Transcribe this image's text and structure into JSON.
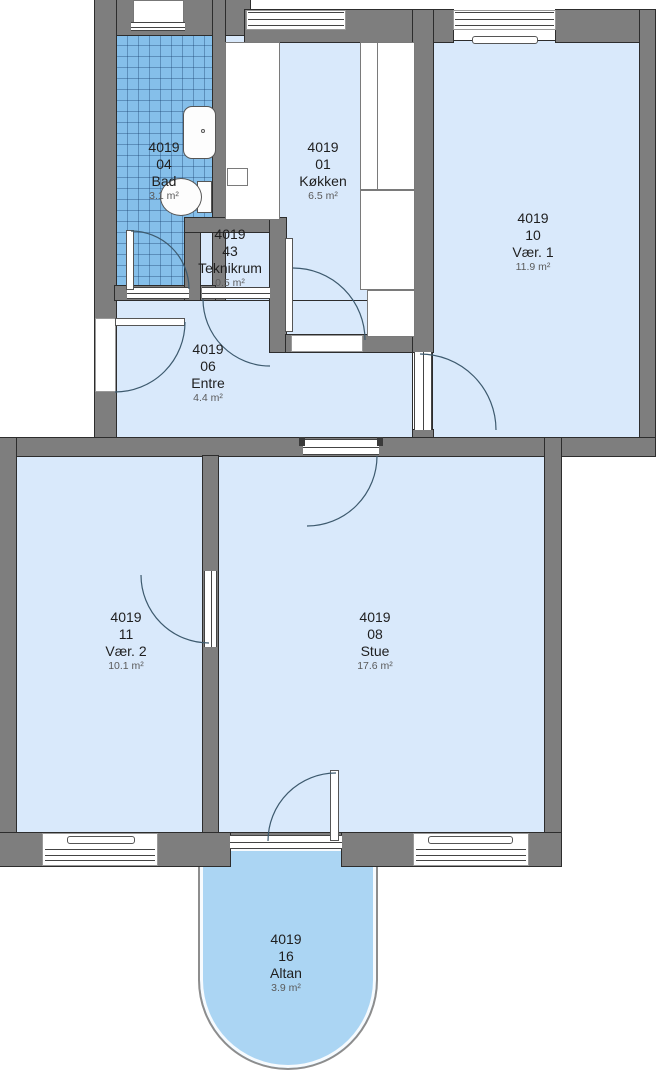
{
  "plan": {
    "unit": "4019",
    "rooms": [
      {
        "unit": "4019",
        "number": "04",
        "name": "Bad",
        "area": "3.1 m²"
      },
      {
        "unit": "4019",
        "number": "01",
        "name": "Køkken",
        "area": "6.5 m²"
      },
      {
        "unit": "4019",
        "number": "43",
        "name": "Teknikrum",
        "area": "0.5 m²"
      },
      {
        "unit": "4019",
        "number": "10",
        "name": "Vær. 1",
        "area": "11.9 m²"
      },
      {
        "unit": "4019",
        "number": "06",
        "name": "Entre",
        "area": "4.4 m²"
      },
      {
        "unit": "4019",
        "number": "11",
        "name": "Vær. 2",
        "area": "10.1 m²"
      },
      {
        "unit": "4019",
        "number": "08",
        "name": "Stue",
        "area": "17.6 m²"
      },
      {
        "unit": "4019",
        "number": "16",
        "name": "Altan",
        "area": "3.9 m²"
      }
    ],
    "colors": {
      "room_fill": "#d9e9fb",
      "wet_room_fill": "#85bfea",
      "balcony_fill": "#abd5f3",
      "wall": "#7e7e7e",
      "outline": "#2d2d2d",
      "door_swing": "#3d5a6e"
    }
  }
}
